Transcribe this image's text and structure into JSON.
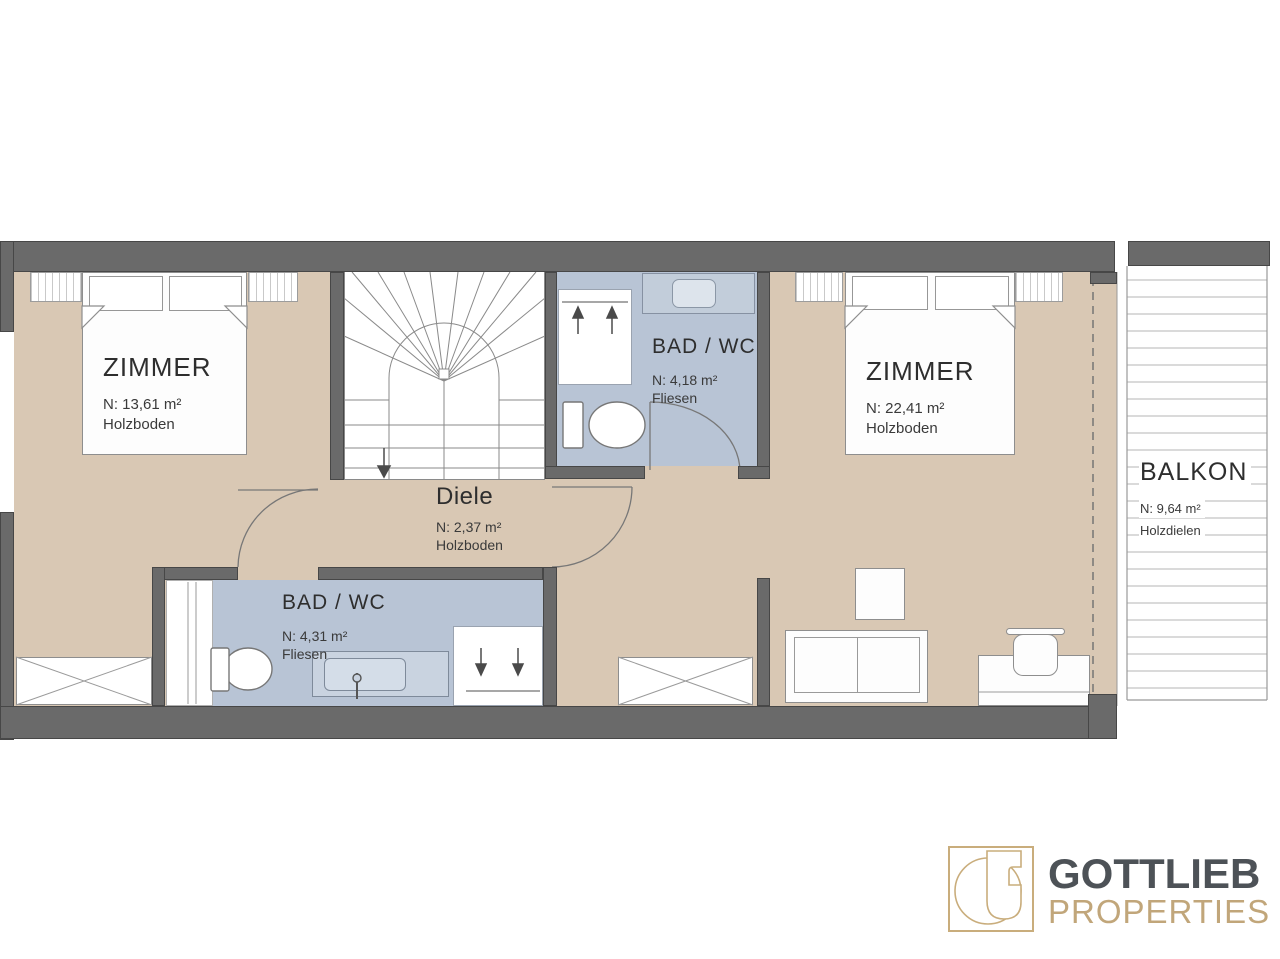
{
  "rooms": {
    "zimmer_left": {
      "name": "ZIMMER",
      "area": "N: 13,61 m²",
      "floor": "Holzboden"
    },
    "bad_wc_top": {
      "name": "BAD / WC",
      "area": "N: 4,18 m²",
      "floor": "Fliesen"
    },
    "zimmer_right": {
      "name": "ZIMMER",
      "area": "N: 22,41 m²",
      "floor": "Holzboden"
    },
    "diele": {
      "name": "Diele",
      "area": "N: 2,37 m²",
      "floor": "Holzboden"
    },
    "bad_wc_bottom": {
      "name": "BAD / WC",
      "area": "N: 4,31 m²",
      "floor": "Fliesen"
    },
    "balkon": {
      "name": "BALKON",
      "area": "N: 9,64 m²",
      "floor": "Holzdielen"
    }
  },
  "branding": {
    "company": "GOTTLIEB",
    "division": "PROPERTIES"
  },
  "colors": {
    "floor_tan": "#d9c8b4",
    "bath_blue": "#b8c4d5",
    "wall_gray": "#6a6a6a",
    "line_gray": "#8a8a8a",
    "logo_gold": "#c1a67a",
    "logo_dark": "#4d5257"
  }
}
